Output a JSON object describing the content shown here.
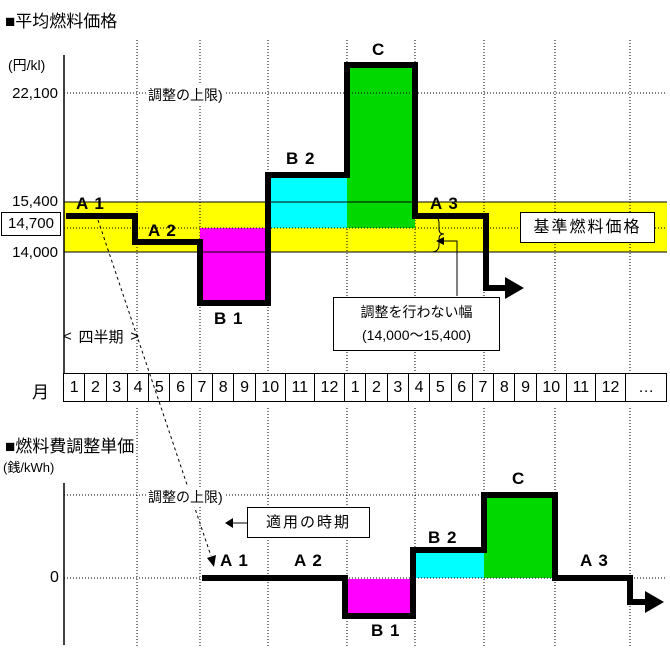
{
  "top_chart": {
    "title": "■平均燃料価格",
    "unit": "(円/kl)",
    "ticks": {
      "t22100": "22,100",
      "t15400": "15,400",
      "t14700": "14,700",
      "t14000": "14,000"
    },
    "upper_limit_label": "調整の上限)",
    "reference_box_label": "基準燃料価格",
    "band_note_line1": "調整を行わない幅",
    "band_note_line2": "(14,000～15,400)",
    "quarter_label": "四半期",
    "quarter_arrow_left": "<",
    "quarter_arrow_right": ">"
  },
  "bottom_chart": {
    "title": "■燃料費調整単価",
    "unit": "(銭/kWh)",
    "zero_tick": "0",
    "upper_limit_label": "調整の上限)",
    "applied_period_box_label": "適用の時期"
  },
  "segments": {
    "a1": "A 1",
    "a2": "A 2",
    "b1": "B 1",
    "b2": "B 2",
    "c": "C",
    "a3": "A 3"
  },
  "month_axis": {
    "label": "月",
    "months": [
      "1",
      "2",
      "3",
      "4",
      "5",
      "6",
      "7",
      "8",
      "9",
      "10",
      "11",
      "12",
      "1",
      "2",
      "3",
      "4",
      "5",
      "6",
      "7",
      "8",
      "9",
      "10",
      "11",
      "12"
    ],
    "ellipsis": "…"
  },
  "colors": {
    "band_yellow": "#FFFF00",
    "negative_magenta": "#FF00FF",
    "positive_cyan": "#00FFFF",
    "capped_green": "#00D800",
    "line_black": "#000000"
  },
  "chart_data": [
    {
      "type": "step-line-with-deviation-bars",
      "title": "平均燃料価格",
      "ylabel": "円/kl",
      "y_ticks": [
        22100,
        15400,
        14700,
        14000
      ],
      "reference_price": 14700,
      "no_adjustment_band": [
        14000,
        15400
      ],
      "adjustment_upper_limit": 22100,
      "x_unit": "四半期（3か月ごと）",
      "categories": [
        "A 1",
        "A 2",
        "B 1",
        "B 2",
        "C",
        "A 3"
      ],
      "values_approx": [
        15000,
        14400,
        12600,
        16000,
        23800,
        15000
      ],
      "bar_fills": {
        "B 1": "#FF00FF",
        "B 2": "#00FFFF",
        "C": "#00D800"
      },
      "notes": [
        "A1・A2・A3は調整を行わない幅(14,000～15,400)の内側",
        "Cは調整の上限(22,100)を超過",
        "基準燃料価格=14,700"
      ]
    },
    {
      "type": "step-line",
      "title": "燃料費調整単価",
      "ylabel": "銭/kWh",
      "y_ticks": [
        0
      ],
      "categories": [
        "A 1",
        "A 2",
        "B 1",
        "B 2",
        "C",
        "A 3"
      ],
      "values_qualitative": [
        "0",
        "0",
        "マイナス調整",
        "プラス調整",
        "調整の上限で頭打ち",
        "0"
      ],
      "lag_quarters": 2,
      "legend_position": "none",
      "grid": true
    }
  ]
}
